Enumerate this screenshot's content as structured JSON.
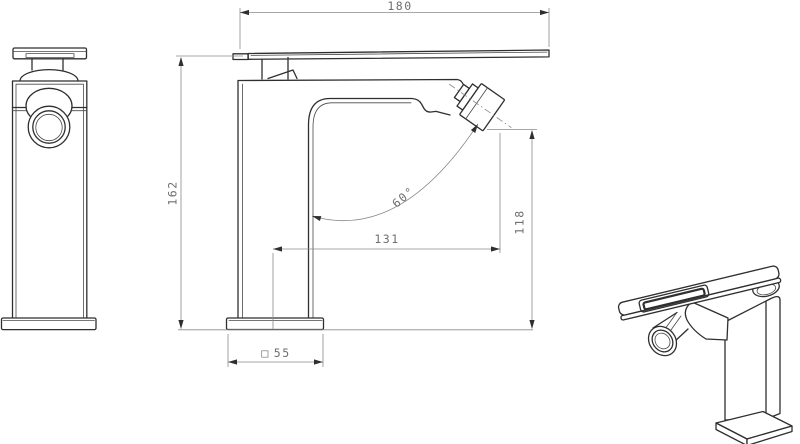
{
  "drawing": {
    "type": "technical-drawing",
    "dims": {
      "overall_width": "180",
      "overall_height": "162",
      "spout_reach": "131",
      "spout_outlet_height": "118",
      "spout_angle": "60°",
      "base_symbol": "□",
      "base_size": "55"
    },
    "colors": {
      "line": "#2f2f2f",
      "dimension": "#8a8a8a",
      "text": "#6f6f6f",
      "background": "#ffffff"
    }
  }
}
